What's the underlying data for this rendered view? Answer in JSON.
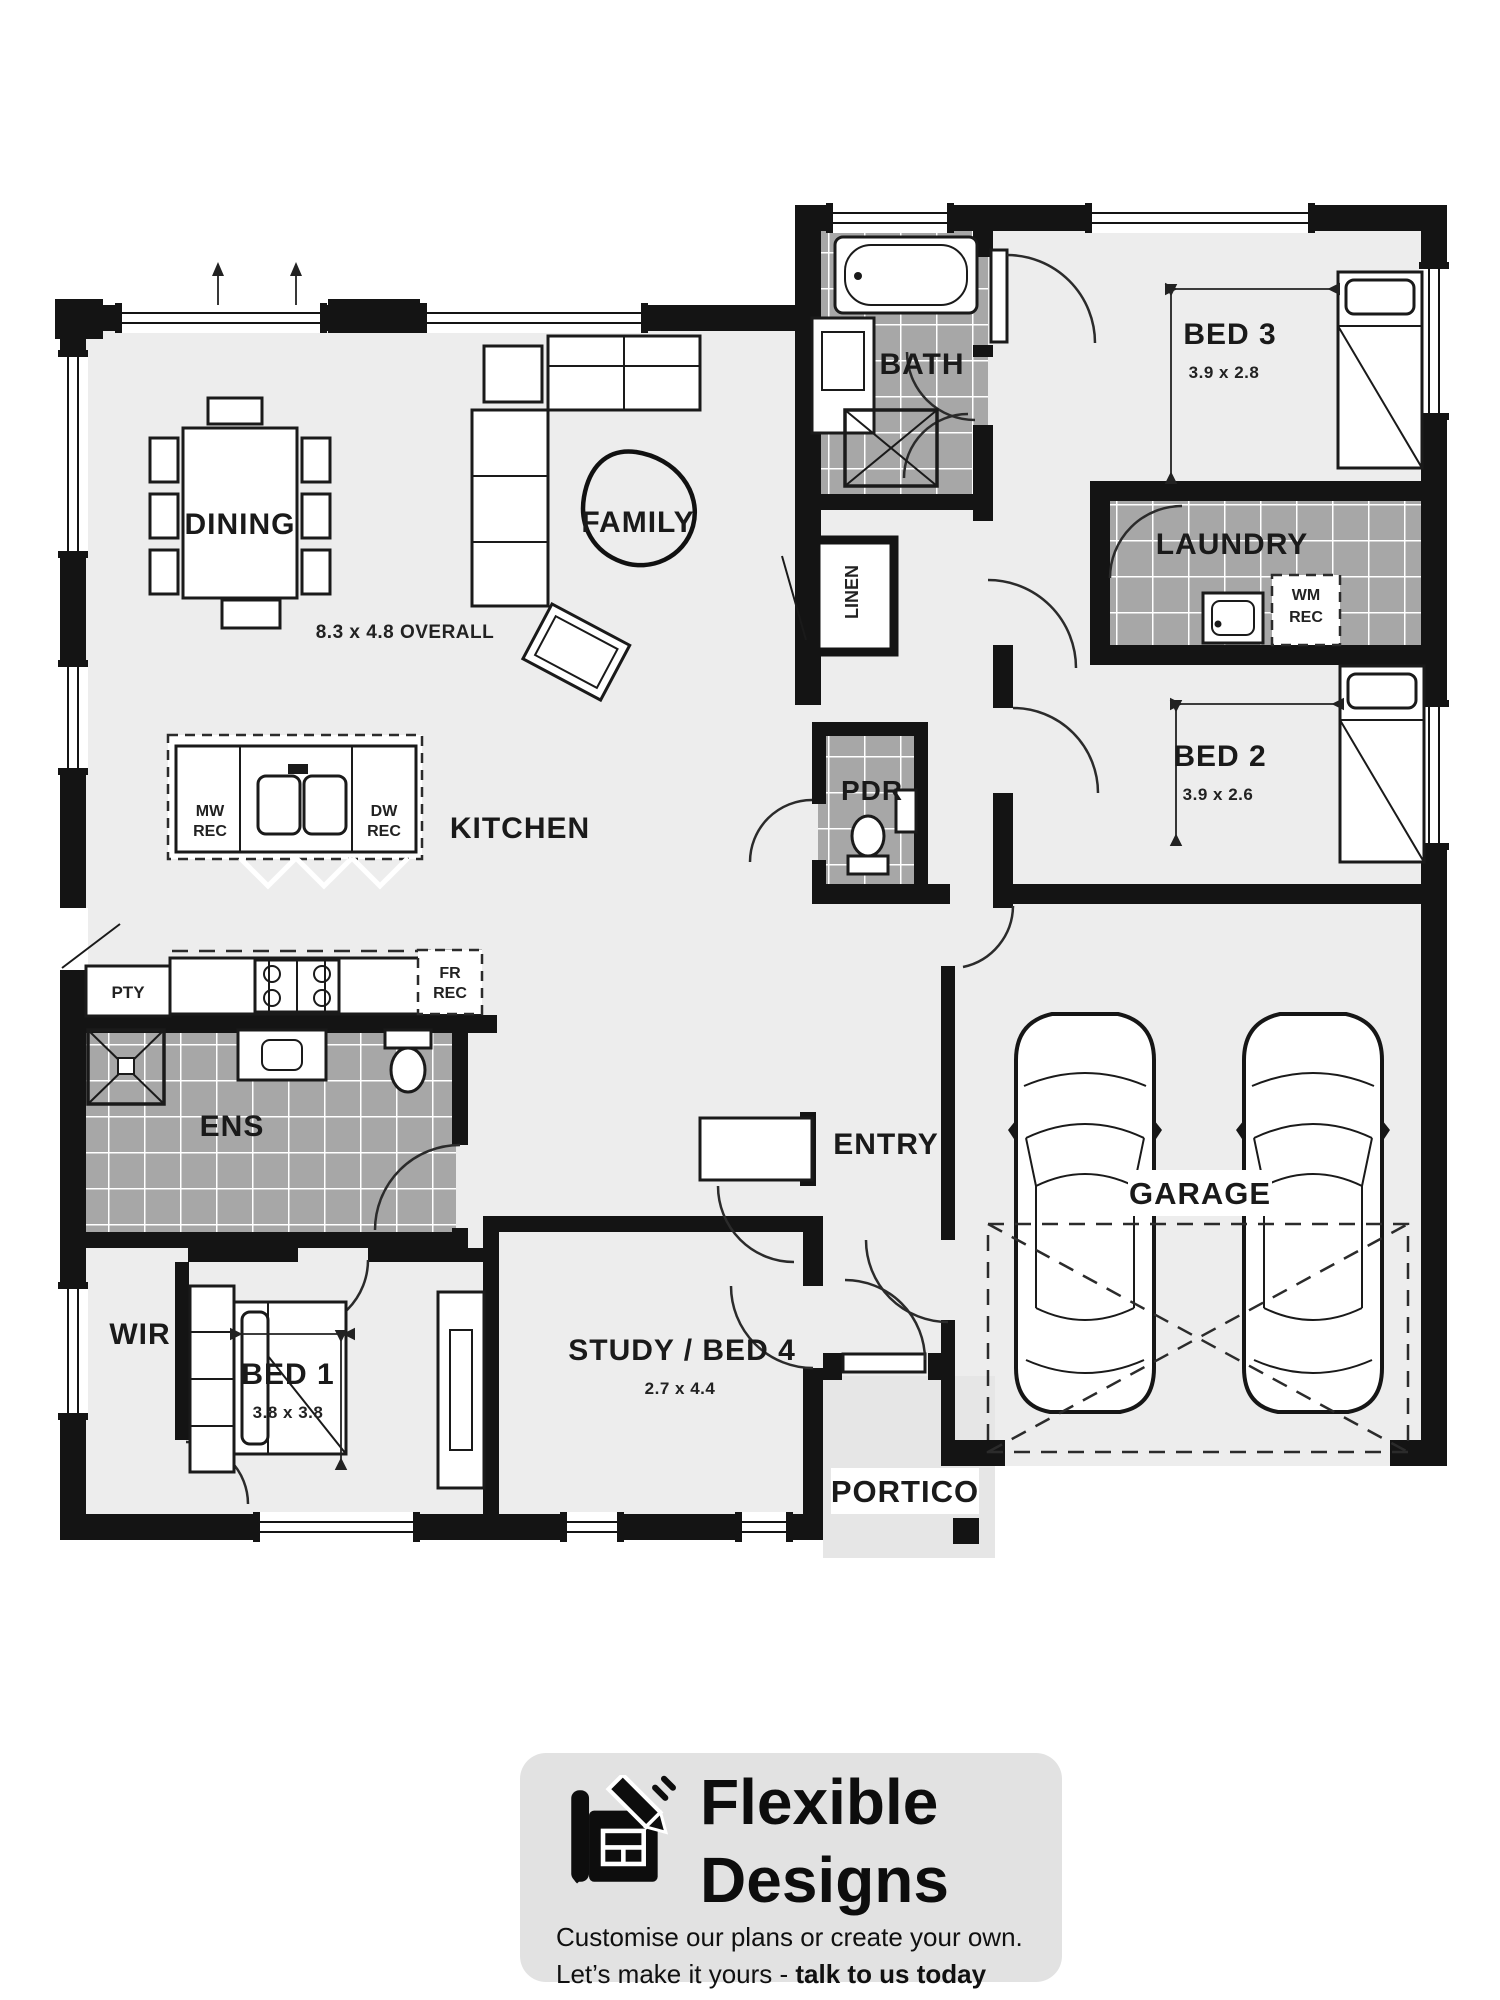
{
  "plan": {
    "overall_dim": "8.3 x 4.8 OVERALL",
    "rooms": {
      "dining": {
        "label": "DINING"
      },
      "family": {
        "label": "FAMILY"
      },
      "kitchen": {
        "label": "KITCHEN"
      },
      "pantry": {
        "label": "PTY"
      },
      "ensuite": {
        "label": "ENS"
      },
      "wir": {
        "label": "WIR"
      },
      "bed1": {
        "label": "BED 1",
        "dim": "3.8 x 3.8"
      },
      "study": {
        "label": "STUDY / BED 4",
        "dim": "2.7 x 4.4"
      },
      "entry": {
        "label": "ENTRY"
      },
      "portico": {
        "label": "PORTICO"
      },
      "garage": {
        "label": "GARAGE"
      },
      "bath": {
        "label": "BATH"
      },
      "linen": {
        "label": "LINEN"
      },
      "pdr": {
        "label": "PDR"
      },
      "laundry": {
        "label": "LAUNDRY"
      },
      "bed2": {
        "label": "BED 2",
        "dim": "3.9 x 2.6"
      },
      "bed3": {
        "label": "BED 3",
        "dim": "3.9 x 2.8"
      }
    },
    "recesses": {
      "mw": {
        "line1": "MW",
        "line2": "REC"
      },
      "dw": {
        "line1": "DW",
        "line2": "REC"
      },
      "fr": {
        "line1": "FR",
        "line2": "REC"
      },
      "wm": {
        "line1": "WM",
        "line2": "REC"
      }
    }
  },
  "footer": {
    "brand_line1": "Flexible",
    "brand_line2": "Designs",
    "tagline1": "Customise our plans or create your own.",
    "tagline2_prefix": "Let’s make it yours - ",
    "tagline2_bold": "talk to us today"
  },
  "colors": {
    "wall": "#141414",
    "floor": "#ededed",
    "tile": "#a7a7a7",
    "tile_grout": "#ffffff",
    "card": "#e2e2e2",
    "paper": "#ffffff"
  }
}
